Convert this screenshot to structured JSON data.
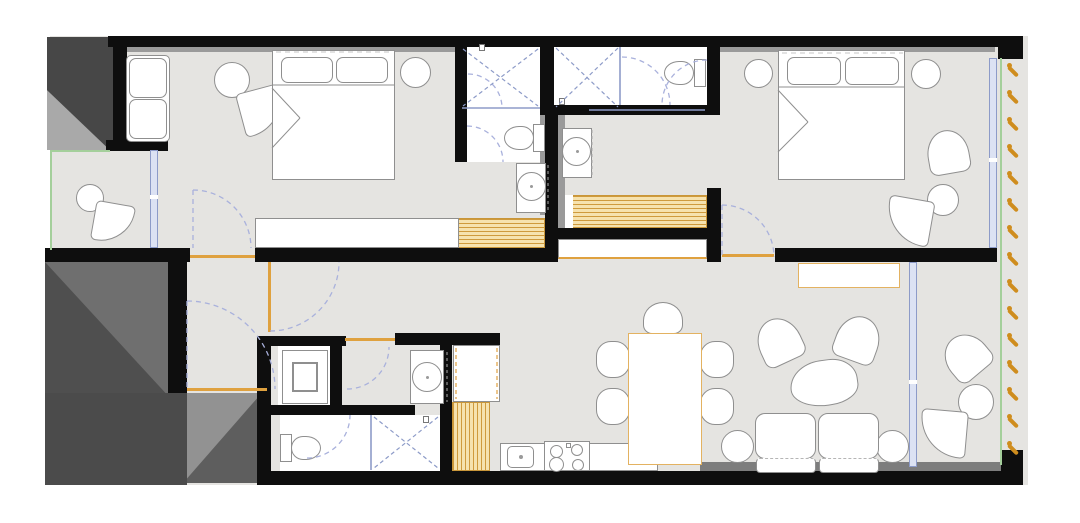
{
  "title": "apartment-floor-plan",
  "colors": {
    "canvas": "#ffffff",
    "floor": "#e5e4e1",
    "wall": "#0e0e0e",
    "stroke": "#8f8f8f",
    "dark_block": "#474747",
    "dark_block_2": "#4f4f4f",
    "dark_block_3": "#5e5e5e",
    "shade_light": "#a9a9a9",
    "shade_mid": "#6f6f6f",
    "shade_soft": "#929292",
    "band_gray": "#9a9a9a",
    "band_dark": "#7d7d7d",
    "wood_fill": "#f6e2ae",
    "wood_stripe": "#cf9a3c",
    "accent_orange": "#dfa13f",
    "window_stroke": "#8d9bc8",
    "window_fill": "#dce2f3",
    "door_arc": "#a9b1dc",
    "glass_blue": "#8d9bc8",
    "green_edge": "#a4cf9b",
    "louver_orange": "#cf8d1e",
    "white": "#ffffff"
  },
  "louvers": {
    "x": 1005,
    "y_start": 62,
    "step": 27,
    "count": 15
  },
  "furniture": [
    "sofa",
    "fan-chair",
    "round-table",
    "double-bed",
    "pillow",
    "nightstand",
    "wardrobe",
    "shower",
    "toilet",
    "washbasin",
    "vanity",
    "washing-machine",
    "tall-cabinet",
    "kitchen-counter",
    "kitchen-sink",
    "cooktop",
    "dining-table",
    "dining-chair",
    "armchair",
    "coffee-table",
    "side-table",
    "sofa-two-seat",
    "sideboard",
    "balcony-chair-set"
  ]
}
